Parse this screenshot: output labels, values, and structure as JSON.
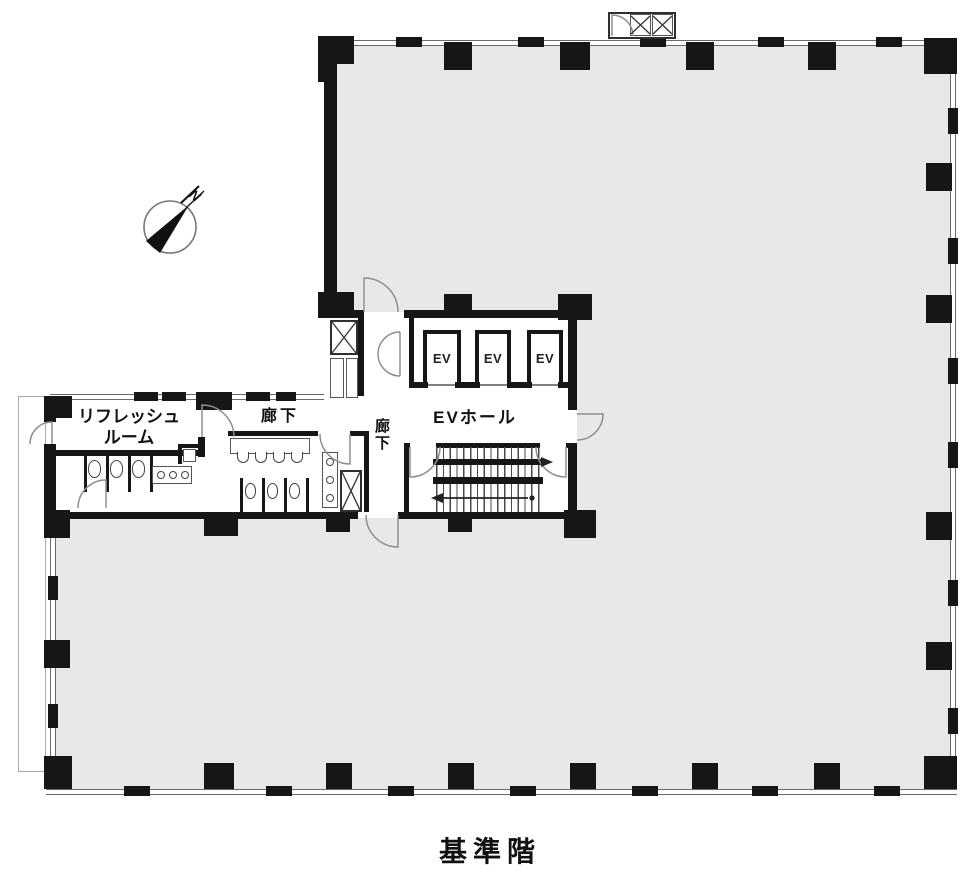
{
  "caption": "基準階",
  "compass": {
    "north_label": "N"
  },
  "labels": {
    "ev_hall": "EVホール",
    "corridor": "廊下",
    "corridor_vertical": "廊下",
    "refresh_room_line1": "リフレッシュ",
    "refresh_room_line2": "ルーム"
  },
  "elevators": [
    {
      "label": "EV"
    },
    {
      "label": "EV"
    },
    {
      "label": "EV"
    }
  ],
  "colors": {
    "tenant_fill": "#e8e8e8",
    "wall": "#161616",
    "door_stroke": "#8f8f8f",
    "fixture_stroke": "#444444"
  }
}
